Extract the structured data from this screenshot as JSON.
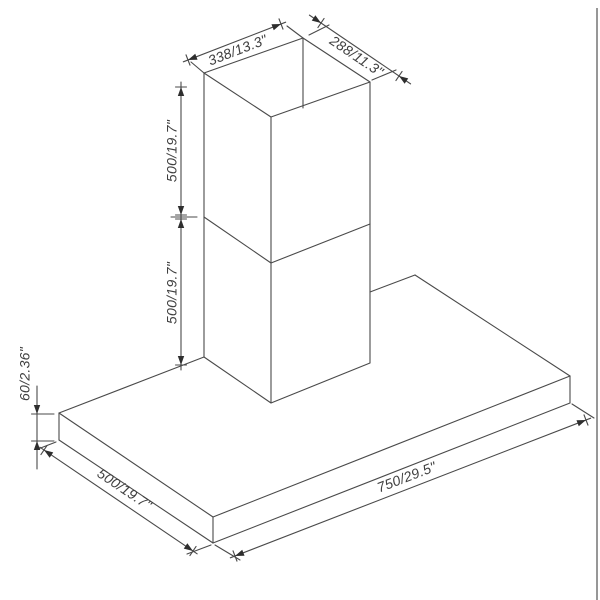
{
  "diagram": {
    "description": "Isometric dimension drawing of a wall-mount range hood with two-piece chimney",
    "canvas": {
      "width": 600,
      "height": 600,
      "background": "#ffffff"
    },
    "style": {
      "line_color": "#4a4a4a",
      "line_width": 1.1,
      "text_color": "#3f3f3f",
      "arrow_color": "#2e2e2e",
      "font_size": 14,
      "border_color": "#979797"
    },
    "page_border": {
      "x": 597,
      "y1": 8,
      "y2": 600,
      "width": 2
    },
    "edges": [
      {
        "name": "chimney-top-opening",
        "points": [
          [
            204,
            73
          ],
          [
            303,
            38
          ],
          [
            370,
            82
          ],
          [
            271,
            117
          ],
          [
            204,
            73
          ]
        ]
      },
      {
        "name": "chimney-inner-back-edge",
        "points": [
          [
            303,
            38
          ],
          [
            303,
            108
          ]
        ]
      },
      {
        "name": "chimney-left-edge",
        "points": [
          [
            204,
            73
          ],
          [
            204,
            357
          ]
        ]
      },
      {
        "name": "chimney-front-edge",
        "points": [
          [
            271,
            117
          ],
          [
            271,
            403
          ]
        ]
      },
      {
        "name": "chimney-right-edge",
        "points": [
          [
            370,
            82
          ],
          [
            370,
            363
          ]
        ]
      },
      {
        "name": "chimney-mid-seam",
        "points": [
          [
            204,
            217
          ],
          [
            271,
            263
          ],
          [
            370,
            224
          ]
        ]
      },
      {
        "name": "chimney-bottom-seam",
        "points": [
          [
            204,
            357
          ],
          [
            271,
            403
          ],
          [
            370,
            363
          ]
        ]
      },
      {
        "name": "hood-top-back-edge-left",
        "points": [
          [
            59,
            413
          ],
          [
            204,
            357
          ]
        ]
      },
      {
        "name": "hood-top-back-edge-right",
        "points": [
          [
            370,
            292
          ],
          [
            415,
            275
          ]
        ]
      },
      {
        "name": "hood-top-right-edge",
        "points": [
          [
            415,
            275
          ],
          [
            570,
            376
          ]
        ]
      },
      {
        "name": "hood-top-front-edge",
        "points": [
          [
            570,
            376
          ],
          [
            213,
            517
          ]
        ]
      },
      {
        "name": "hood-top-left-edge",
        "points": [
          [
            213,
            517
          ],
          [
            59,
            413
          ]
        ]
      },
      {
        "name": "hood-west-corner-edge",
        "points": [
          [
            59,
            413
          ],
          [
            59,
            440
          ]
        ]
      },
      {
        "name": "hood-south-corner-edge",
        "points": [
          [
            213,
            517
          ],
          [
            213,
            543
          ]
        ]
      },
      {
        "name": "hood-east-corner-edge",
        "points": [
          [
            570,
            376
          ],
          [
            570,
            403
          ]
        ]
      },
      {
        "name": "hood-bottom-left-edge",
        "points": [
          [
            59,
            440
          ],
          [
            213,
            543
          ]
        ]
      },
      {
        "name": "hood-bottom-front-edge",
        "points": [
          [
            213,
            543
          ],
          [
            570,
            403
          ]
        ]
      }
    ],
    "extension_lines": [
      {
        "name": "ext-338-left",
        "points": [
          [
            204,
            73
          ],
          [
            191,
            62
          ]
        ]
      },
      {
        "name": "ext-338-right",
        "points": [
          [
            303,
            38
          ],
          [
            287,
            26
          ]
        ]
      },
      {
        "name": "ext-288-left",
        "points": [
          [
            309,
            35
          ],
          [
            329,
            25
          ]
        ]
      },
      {
        "name": "ext-288-right",
        "points": [
          [
            372,
            80
          ],
          [
            396,
            70
          ]
        ]
      },
      {
        "name": "ext-mid-seam",
        "points": [
          [
            197,
            217
          ],
          [
            171,
            217
          ]
        ]
      },
      {
        "name": "ext-60-top",
        "points": [
          [
            42,
            414
          ],
          [
            54,
            414
          ]
        ]
      },
      {
        "name": "ext-60-bottom",
        "points": [
          [
            42,
            441
          ],
          [
            54,
            441
          ]
        ]
      },
      {
        "name": "ext-750-left",
        "points": [
          [
            215,
            545
          ],
          [
            240,
            560
          ]
        ]
      },
      {
        "name": "ext-750-right",
        "points": [
          [
            572,
            404
          ],
          [
            594,
            418
          ]
        ]
      },
      {
        "name": "ext-500bl-top",
        "points": [
          [
            56,
            442
          ],
          [
            38,
            449
          ]
        ]
      },
      {
        "name": "ext-500bl-bottom",
        "points": [
          [
            211,
            545
          ],
          [
            187,
            554
          ]
        ]
      }
    ],
    "dimensions": [
      {
        "name": "duct-top-width",
        "label": "338/13.3\"",
        "p1": [
          188,
          60
        ],
        "p2": [
          281,
          24
        ],
        "style": "out",
        "label_pos": [
          238,
          51
        ],
        "rot": -21
      },
      {
        "name": "duct-top-depth",
        "label": "288/11.3\"",
        "p1": [
          321,
          23
        ],
        "p2": [
          399,
          76
        ],
        "style": "in",
        "tail": 14,
        "label_pos": [
          356,
          57
        ],
        "rot": 34
      },
      {
        "name": "upper-chimney-height",
        "label": "500/19.7\"",
        "p1": [
          181,
          87
        ],
        "p2": [
          181,
          215
        ],
        "style": "out",
        "label_pos": [
          173,
          151
        ],
        "rot": -90
      },
      {
        "name": "lower-chimney-height",
        "label": "500/19.7\"",
        "p1": [
          181,
          219
        ],
        "p2": [
          181,
          365
        ],
        "style": "out",
        "label_pos": [
          173,
          293
        ],
        "rot": -90
      },
      {
        "name": "hood-body-height",
        "label": "60/2.36\"",
        "p1": [
          37,
          414
        ],
        "p2": [
          37,
          441
        ],
        "style": "in",
        "tail": 28,
        "label_pos": [
          26,
          374
        ],
        "rot": -90
      },
      {
        "name": "hood-body-depth",
        "label": "500/19.7\"",
        "p1": [
          44,
          450
        ],
        "p2": [
          193,
          551
        ],
        "style": "out",
        "label_pos": [
          124,
          490
        ],
        "rot": 34
      },
      {
        "name": "hood-body-width",
        "label": "750/29.5\"",
        "p1": [
          235,
          556
        ],
        "p2": [
          586,
          420
        ],
        "style": "out",
        "label_pos": [
          407,
          478
        ],
        "rot": -21
      }
    ]
  }
}
